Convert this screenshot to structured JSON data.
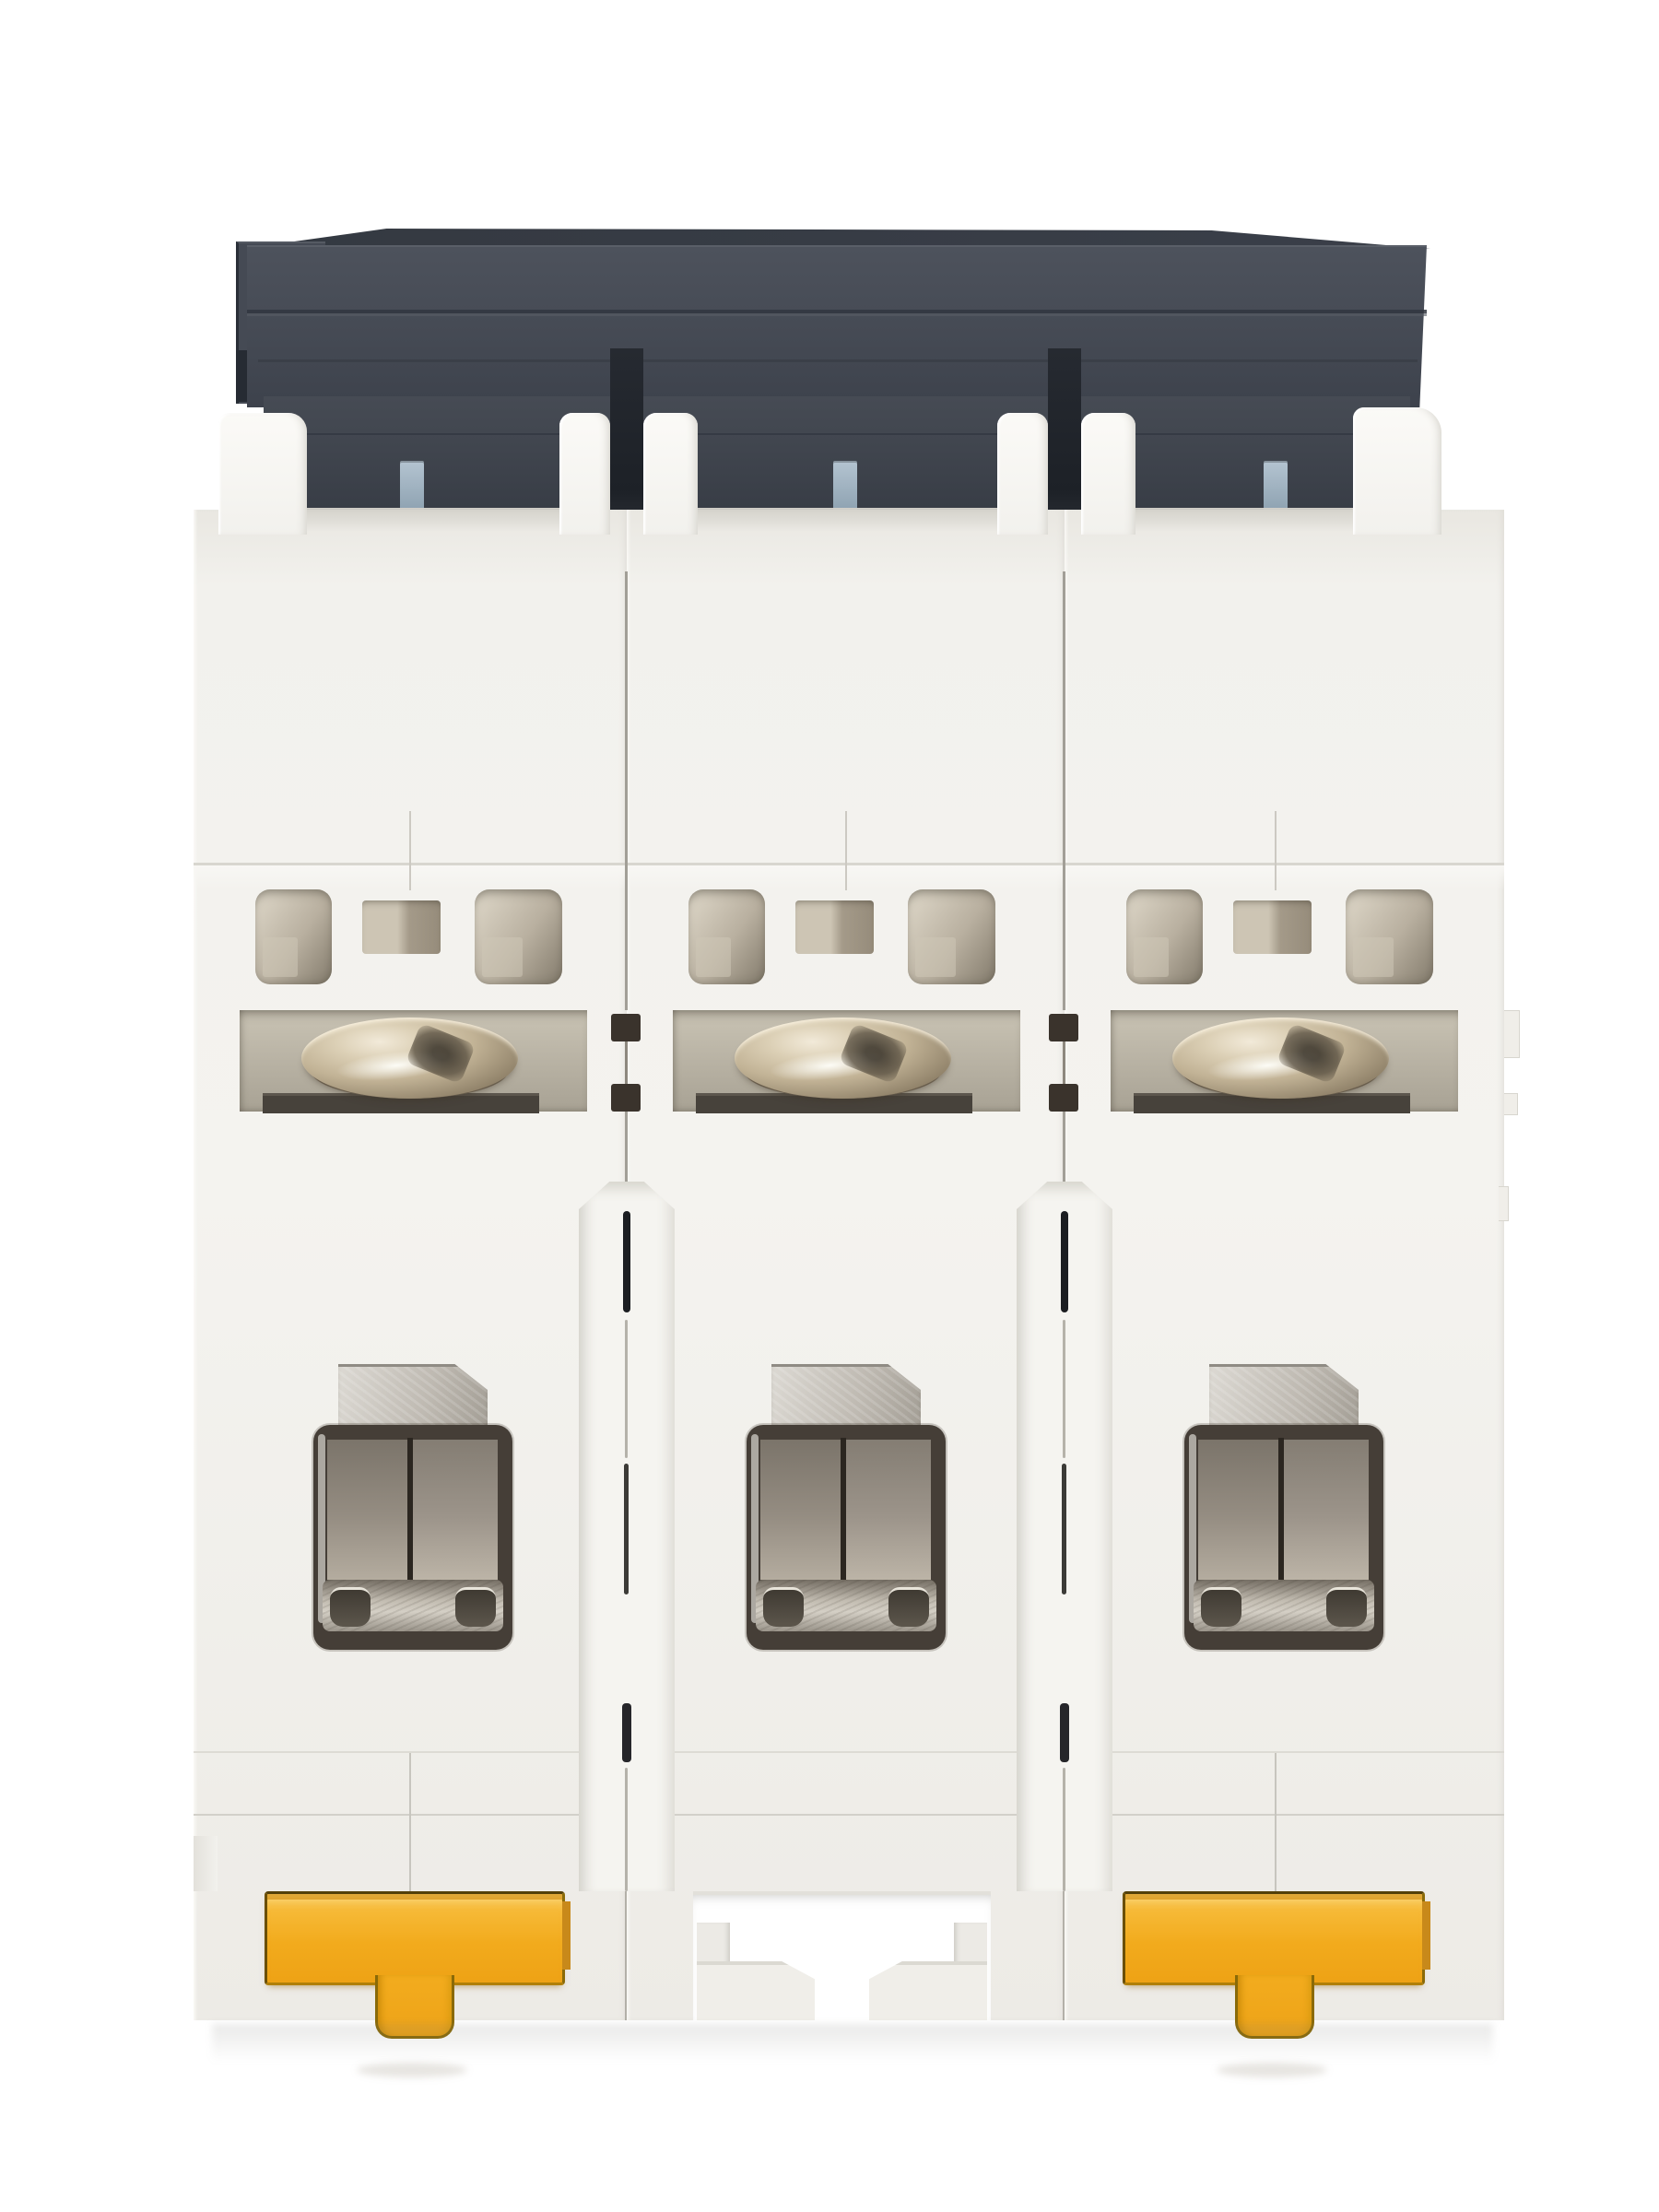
{
  "meta": {
    "type": "product-photo",
    "subject": "Bottom view of a 3-pole DIN-rail miniature circuit breaker",
    "background_color": "#ffffff"
  },
  "device": {
    "pole_count": 3,
    "visible_parts": [
      {
        "name": "top-cover",
        "count": 1,
        "desc": "dark charcoal housing cover with stepped ridges",
        "color": "#454a54"
      },
      {
        "name": "pole-module",
        "count": 3,
        "desc": "white plastic pole housings side by side",
        "color": "#f2f1ed"
      },
      {
        "name": "guide-tab",
        "count": 3,
        "desc": "small blue-gray tabs under the cover, one per pole",
        "color": "#a7b9c7"
      },
      {
        "name": "vent-slot",
        "count": 9,
        "desc": "three tan recessed slots per pole above the screw chamber",
        "color": "#b9b0a0"
      },
      {
        "name": "terminal-screw",
        "count": 3,
        "desc": "shiny metal clamp screws seen edge-on in recesses",
        "color": "#c2b396"
      },
      {
        "name": "terminal-opening",
        "count": 3,
        "desc": "square wire entry windows with metal clamp plate",
        "color": "#453e37"
      },
      {
        "name": "din-rail-clip",
        "count": 2,
        "desc": "yellow T-shaped slide clips on outer poles",
        "color": "#f2ab1d"
      },
      {
        "name": "center-latch-cutout",
        "count": 1,
        "desc": "white latch cut-out with two hooks on middle pole",
        "color": "#ffffff"
      }
    ]
  },
  "colors": {
    "bg": "#ffffff",
    "housing_top": "#3a3f49",
    "housing_face_hi": "#4d525c",
    "housing_face": "#454a54",
    "housing_face_lo": "#3d424c",
    "housing_skirt": "#41464f",
    "housing_skirt_lo": "#383d46",
    "edge_dark": "#2d323b",
    "notch_dark": "#1d2127",
    "tab_blue_hi": "#b4c4d1",
    "tab_blue_lo": "#8fa3b2",
    "plastic": "#f2f1ed",
    "plastic_hi": "#fbfaf7",
    "plastic_shade": "#dcdad4",
    "plastic_line": "#d8d6cf",
    "slot_light": "#d8d1c2",
    "slot_mid": "#b9b0a0",
    "slot_dark": "#837b6c",
    "recess_hi": "#c9c3b4",
    "recess_lo": "#a8a294",
    "underplate": "#47423b",
    "screw_hi": "#f2ead9",
    "screw_mid": "#c2b396",
    "screw_lo": "#8a7c64",
    "frame_dark": "#453e37",
    "panel_top": "#7b746a",
    "panel_bot": "#b4ac9f",
    "divider": "#2b2620",
    "metal_hi": "#dcd9d3",
    "metal_lo": "#a39e95",
    "metal_bottom": "#d4cfc5",
    "curl_dark": "#3f3a32",
    "seam": "#a29f97",
    "seam_dark": "#1b1d21",
    "yellow_hi": "#f9c95a",
    "yellow": "#f2ab1d",
    "yellow_lo": "#eea215",
    "yellow_line": "#6b4f03",
    "yellow_amber": "#c8891a"
  }
}
